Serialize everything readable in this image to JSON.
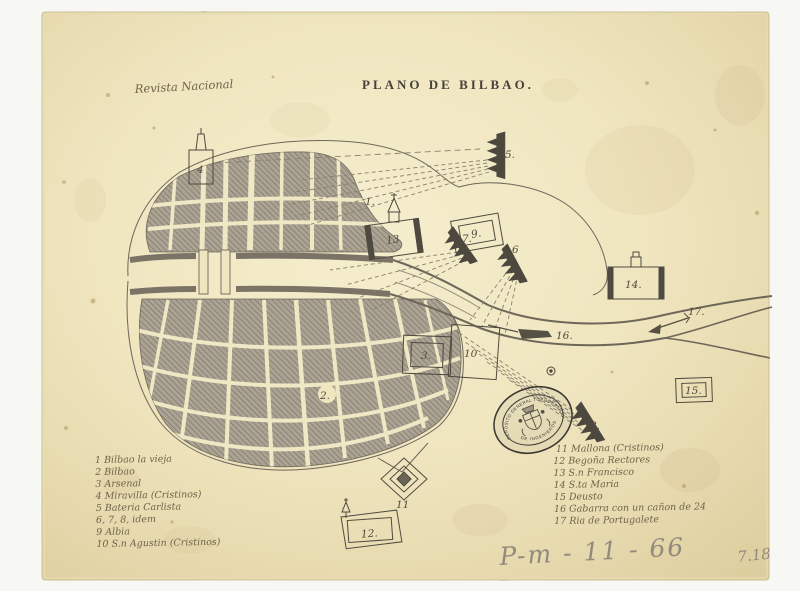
{
  "title": "PLANO DE BILBAO.",
  "handwriting": {
    "revista": "Revista Nacional",
    "pencil_code": "P-m - 11 - 66",
    "pencil_num": "7.18"
  },
  "stamp": {
    "arc_top": "DEPOSITO GENERAL TOPOGRAFICO",
    "arc_bottom": "DE INGENIEROS"
  },
  "legend_left": {
    "items": [
      "1 Bilbao la vieja",
      "2 Bilbao",
      "3 Arsenal",
      "4 Miravilla (Cristinos)",
      "5 Bateria Carlista",
      "6, 7, 8, idem",
      "9 Albia",
      "10 S.n Agustin (Cristinos)"
    ]
  },
  "legend_right": {
    "items": [
      "11 Mallona (Cristinos)",
      "12 Begoña Rectores",
      "13 S.n Francisco",
      "14 S.ta Maria",
      "15 Deusto",
      "16 Gabarra con un cañon de 24",
      "17 Ria de Portugalete"
    ]
  },
  "map_labels": {
    "n1": "1.",
    "n2": "2.",
    "n3": "3.",
    "n4": "4",
    "n5": "5.",
    "n6": "6",
    "n7": "7.",
    "n8": "8.",
    "n9": "9.",
    "n10": "10",
    "n11": "11",
    "n12": "12.",
    "n13": "13",
    "n14": "14.",
    "n15": "15.",
    "n16": "16.",
    "n17": "17."
  },
  "colors": {
    "paper": "#efe6c0",
    "ink": "#55503f",
    "bank": "#7b7365",
    "stamp_ink": "#3c3933",
    "pencil": "#918b7d"
  }
}
